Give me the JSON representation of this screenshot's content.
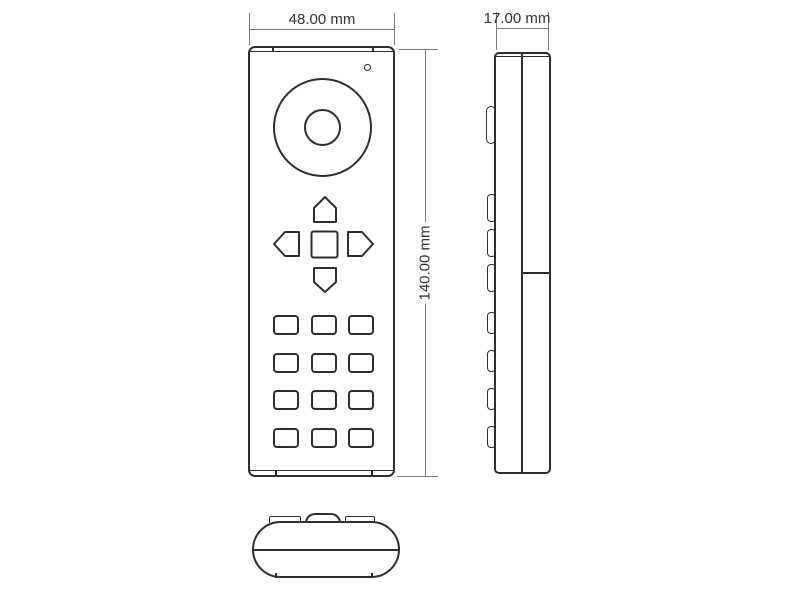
{
  "dimensions": {
    "width_label": "48.00 mm",
    "depth_label": "17.00 mm",
    "height_label": "140.00 mm"
  },
  "colors": {
    "outline": "#2e2e2e",
    "dimension_line": "#7b7b7b",
    "dimension_text": "#333333",
    "background": "#ffffff"
  },
  "views": {
    "front": {
      "led_indicator": true,
      "scroll_wheel": true,
      "dpad_keys": 5,
      "keypad_rows": 4,
      "keypad_cols": 3
    },
    "side": {
      "button_bumps": 8
    },
    "bottom": {
      "tabs": 2,
      "dome_bump": 1
    }
  }
}
